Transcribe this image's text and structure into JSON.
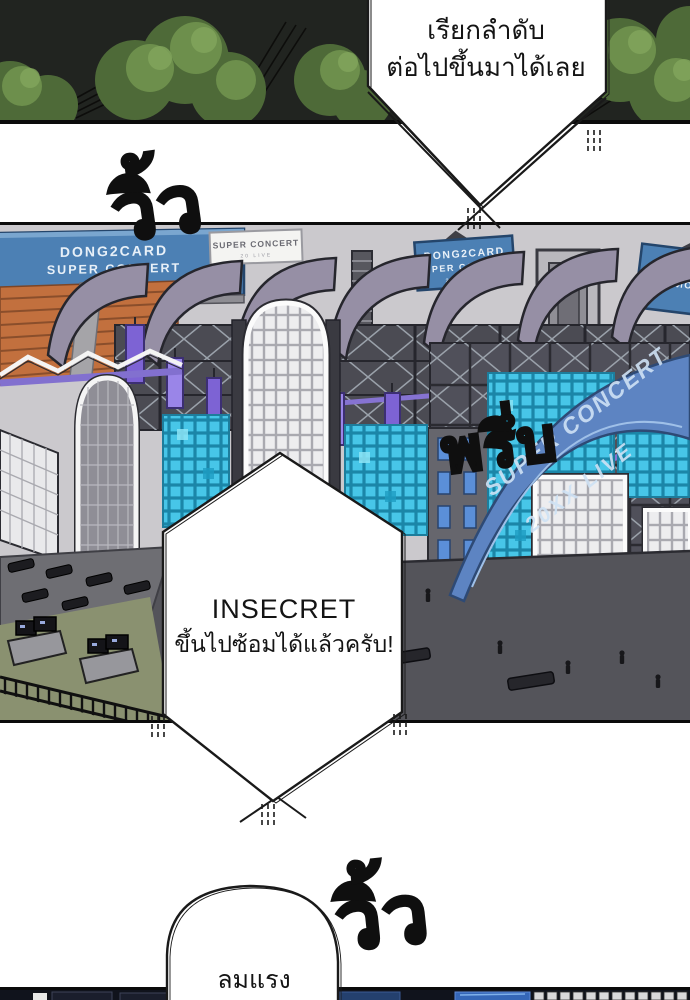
{
  "page": {
    "background": "#ffffff",
    "kind": "webtoon-comic-page"
  },
  "sfx": {
    "top": "วิ้ว",
    "middle": "พรึ่บ",
    "bottom": "วิ้ว"
  },
  "bubbles": {
    "caller": {
      "line1": "เรียกลำดับ",
      "line2": "ต่อไปขึ้นมาได้เลย"
    },
    "insecret": {
      "line1": "INSECRET",
      "line2": "ขึ้นไปซ้อมได้แล้วครับ!"
    },
    "wind": {
      "text": "ลมแรง"
    }
  },
  "stage": {
    "billboard_left": {
      "line1": "DONG2CARD",
      "line2": "SUPER CONCERT",
      "line3": "20 LIVE"
    },
    "banner_white": {
      "line1": "SUPER CONCERT",
      "line2": "20 LIVE"
    },
    "billboard_mid": {
      "line1": "DONG2CARD",
      "line2": "SUPER CONCERT",
      "line3": "20 LIVE"
    },
    "billboard_right": {
      "line1": "DONG2CARD",
      "line2": "SUPER CONCERT"
    },
    "ribbon": {
      "line1": "SUPER CONCERT",
      "line2": "20XX LIVE"
    }
  },
  "colors": {
    "billboard_blue": "#4c80b4",
    "roof_gray": "#968fa5",
    "banner_purple": "#7d63d4",
    "led_cyan": "#47c6e8",
    "ribbon_blue": "#5d84c2",
    "ground_gray": "#54545a",
    "grass_olive": "#8a9170",
    "seat_orange": "#c2703e",
    "night_panel": "#212420"
  }
}
